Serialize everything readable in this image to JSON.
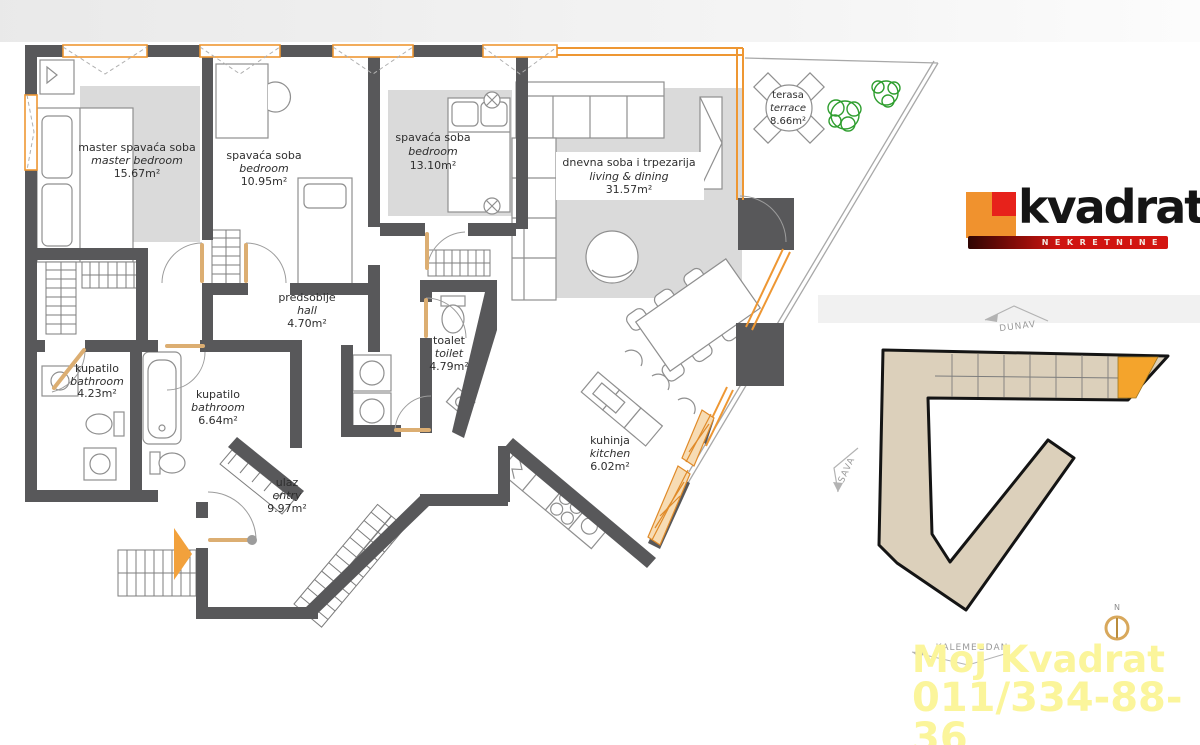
{
  "floorplan": {
    "rooms": [
      {
        "id": "master-bedroom",
        "name_sr": "master spavaća soba",
        "name_en": "master bedroom",
        "area": "15.67m²"
      },
      {
        "id": "bedroom-2",
        "name_sr": "spavaća soba",
        "name_en": "bedroom",
        "area": "10.95m²"
      },
      {
        "id": "bedroom-3",
        "name_sr": "spavaća soba",
        "name_en": "bedroom",
        "area": "13.10m²"
      },
      {
        "id": "living-dining",
        "name_sr": "dnevna soba i trpezarija",
        "name_en": "living & dining",
        "area": "31.57m²"
      },
      {
        "id": "terrace",
        "name_sr": "terasa",
        "name_en": "terrace",
        "area": "8.66m²"
      },
      {
        "id": "hall",
        "name_sr": "predsoblje",
        "name_en": "hall",
        "area": "4.70m²"
      },
      {
        "id": "toilet",
        "name_sr": "toalet",
        "name_en": "toilet",
        "area": "4.79m²"
      },
      {
        "id": "bathroom-small",
        "name_sr": "kupatilo",
        "name_en": "bathroom",
        "area": "4.23m²"
      },
      {
        "id": "bathroom-large",
        "name_sr": "kupatilo",
        "name_en": "bathroom",
        "area": "6.64m²"
      },
      {
        "id": "entry",
        "name_sr": "ulaz",
        "name_en": "entry",
        "area": "9.97m²"
      },
      {
        "id": "kitchen",
        "name_sr": "kuhinja",
        "name_en": "kitchen",
        "area": "6.02m²"
      }
    ],
    "colors": {
      "wall": "#58585a",
      "accent": "#ee9733",
      "furniture_fill": "#dadada",
      "plant": "#2f9e2f"
    }
  },
  "logo": {
    "brand": "kvadrat",
    "tagline": "NEKRETNINE",
    "orange": "#f0922e",
    "red": "#e7221b",
    "bar": "#d31510"
  },
  "siteplan": {
    "labels": {
      "dunav": "DUNAV",
      "sava": "SAVA",
      "kalemegdan": "KALEMEGDAN",
      "north": "N"
    },
    "building_fill": "#dcd0bb",
    "highlight": "#f4a42c"
  },
  "watermark": {
    "line1": "Moj Kvadrat",
    "line2": "011/334-88-36",
    "color": "#fbf59b"
  }
}
